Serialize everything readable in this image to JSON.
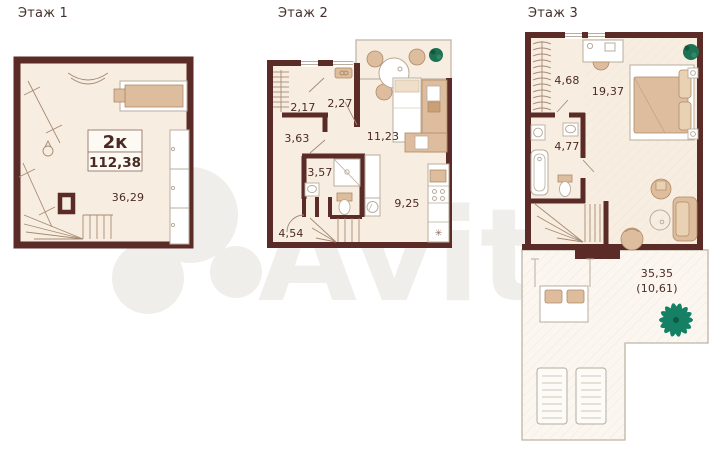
{
  "watermark": {
    "brand": "Avito"
  },
  "colors": {
    "wall": "#5b2b28",
    "floor_fill": "#f7eee1",
    "terrace_fill": "#fbf7f0",
    "furniture": "#ddbd9e",
    "plant_green": "#1e7152",
    "palm_teal": "#158064",
    "label_text": "#4c2a24"
  },
  "unit": {
    "type_label": "2к",
    "total_area": "112,38"
  },
  "floors": [
    {
      "title": "Этаж 1",
      "rooms": [
        {
          "area": "36,29"
        }
      ]
    },
    {
      "title": "Этаж 2",
      "fridge_symbol": "✳",
      "rooms": [
        {
          "area": "2,17"
        },
        {
          "area": "2,27"
        },
        {
          "area": "3,63"
        },
        {
          "area": "11,23"
        },
        {
          "area": "3,57"
        },
        {
          "area": "9,25"
        },
        {
          "area": "4,54"
        }
      ]
    },
    {
      "title": "Этаж 3",
      "rooms": [
        {
          "area": "4,68"
        },
        {
          "area": "19,37"
        },
        {
          "area": "4,77"
        }
      ],
      "terrace": {
        "area": "35,35",
        "area_reduced": "(10,61)"
      }
    }
  ]
}
